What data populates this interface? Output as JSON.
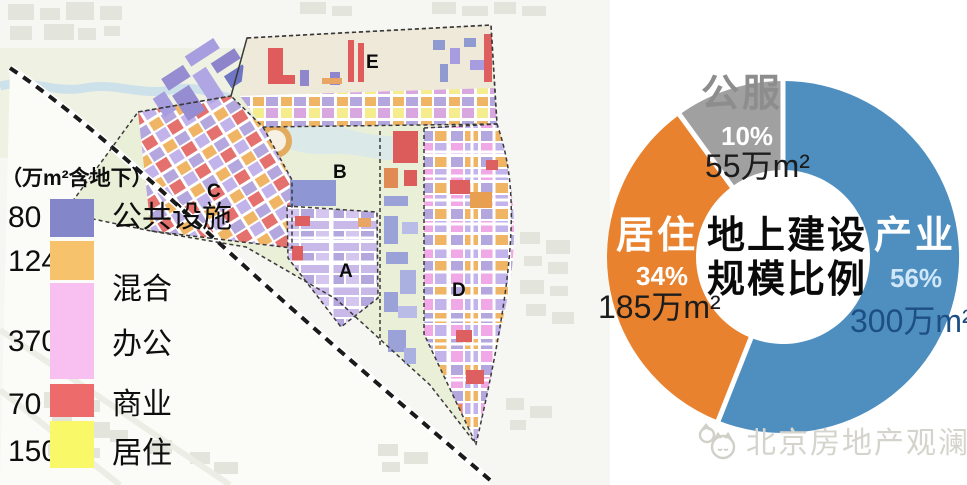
{
  "legend": {
    "title": "（万m²含地下）",
    "rows": [
      {
        "value": "80",
        "label": "公共设施",
        "color": "#8386c8"
      },
      {
        "value": "124",
        "label": "混合",
        "color": "#f7c26c"
      },
      {
        "value": "370",
        "label": "办公",
        "color": "#f8c0f0"
      },
      {
        "value": "70",
        "label": "商业",
        "color": "#ee6b6b"
      },
      {
        "value": "150",
        "label": "居住",
        "color": "#f8f868"
      }
    ]
  },
  "map": {
    "zone_labels": [
      "A",
      "B",
      "C",
      "D",
      "E"
    ]
  },
  "donut": {
    "center_line1": "地上建设",
    "center_line2": "规模比例",
    "segments": [
      {
        "name": "产业",
        "pct": "56%",
        "amount": "300万m²",
        "color": "#4e8fc0"
      },
      {
        "name": "居住",
        "pct": "34%",
        "amount": "185万m²",
        "color": "#e8822f"
      },
      {
        "name": "公服",
        "pct": "10%",
        "amount": "55万m²",
        "color": "#a0a0a0"
      }
    ]
  },
  "watermark": {
    "text": "北京房地产观澜"
  },
  "chart_data": [
    {
      "type": "pie",
      "subtype": "donut",
      "title": "地上建设规模比例",
      "labels": [
        "产业",
        "居住",
        "公服"
      ],
      "values_pct": [
        56,
        34,
        10
      ],
      "values_area_wan_m2": [
        300,
        185,
        55
      ],
      "value_labels": [
        "300万m²",
        "185万m²",
        "55万m²"
      ],
      "colors": [
        "#4e8fc0",
        "#e8822f",
        "#a0a0a0"
      ],
      "start_angle_deg": 0,
      "direction": "clockwise",
      "center_text": [
        "地上建设",
        "规模比例"
      ]
    },
    {
      "type": "bar",
      "title": "（万m²含地下）",
      "categories": [
        "公共设施",
        "混合",
        "办公",
        "商业",
        "居住"
      ],
      "values": [
        80,
        124,
        370,
        70,
        150
      ],
      "colors": [
        "#8386c8",
        "#f7c26c",
        "#f8c0f0",
        "#ee6b6b",
        "#f8f868"
      ],
      "orientation": "vertical-stacked-legend"
    }
  ]
}
